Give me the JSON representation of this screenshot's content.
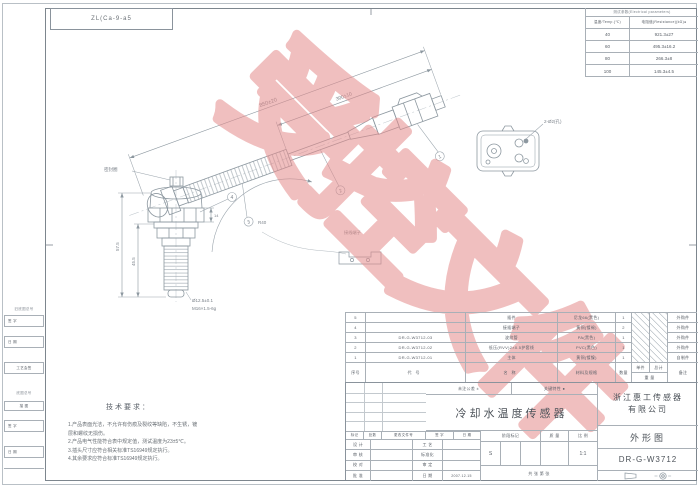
{
  "page": {
    "code_box": "ZL(Ca-9-a5",
    "watermark": "受控文件",
    "watermark_color": "#e58c8c"
  },
  "etable": {
    "title": "测试参数(Electrical parameters)",
    "col_temp": "温度/Temp.(℃)",
    "col_res": "电阻值(Resistance)(kΩ)●",
    "rows": [
      [
        "40",
        "921.3±27"
      ],
      [
        "60",
        "495.3±16.2"
      ],
      [
        "80",
        "266.3±8"
      ],
      [
        "100",
        "145.3±4.5"
      ]
    ]
  },
  "drawing": {
    "dim_overall": "850±20",
    "dim_cable": "300±10",
    "seal_label": "密封圈",
    "radius_label": "R40",
    "dim_h1": "57.5",
    "dim_h2": "45.5",
    "dim_hex": "14",
    "callout_dia": "Ø12.5±0.1",
    "callout_thread": "M16×1.5-6g",
    "connector_callout": "2-Ø2(孔)",
    "clip_label": "接线端子",
    "balloons": [
      "1",
      "2",
      "3",
      "4"
    ]
  },
  "notes": {
    "title": "技术要求：",
    "lines": [
      "1.产品表面光洁，不允许有伤痕及裂纹等缺陷，不生锈，镀",
      "   层和螺纹无损伤。",
      "2.产品电气性能符合表中规定值，测试温度为23±5℃。",
      "3.插头尺寸应符合相关标准TS16949规定执行。",
      "4.其余要求应符合标准TS16949规定执行。"
    ]
  },
  "bom": {
    "headers": {
      "no": "序号",
      "code": "代号",
      "name": "名称",
      "material": "材料及规格",
      "qty": "数量",
      "w1": "单件",
      "w2": "总计",
      "w": "重 量",
      "remark": "备注"
    },
    "rows": [
      [
        "5",
        "",
        "插件",
        "尼龙66(黑色)",
        "1",
        "外购件"
      ],
      [
        "4",
        "",
        "接插端子",
        "黄铜(镀锡)",
        "2",
        "外购件"
      ],
      [
        "3",
        "DR-G-W3712-03",
        "波纹管",
        "PA(黑色)",
        "1",
        "外购件"
      ],
      [
        "2",
        "DR-G-W3712-02",
        "低压(RVV)2×0.5护套线",
        "PVC(黑色)",
        "1",
        "外购件"
      ],
      [
        "1",
        "DR-G-W3712-01",
        "主体",
        "黄铜(镀镍)",
        "1",
        "自制件"
      ]
    ]
  },
  "tblock": {
    "rev_header": [
      "标记",
      "处数",
      "更改文件号",
      "签 字",
      "日 期"
    ],
    "sign_rows": [
      [
        "设 计",
        "工 艺"
      ],
      [
        "审 核",
        "标准化"
      ],
      [
        "校 对",
        "审 定"
      ],
      [
        "批 准",
        "日 期"
      ]
    ],
    "date": "2007.12.15",
    "tol": "未注公差 ±",
    "key": "关键特性 ●",
    "product": "冷却水温度传感器",
    "stage": "阶段标记",
    "mass": "质 量",
    "scale": "比 例",
    "stage_val": "S",
    "scale_val": "1:1",
    "sheet_info": "共  张   第  张",
    "company1": "浙江惠工传感器",
    "company2": "有限公司",
    "doc_type": "外形图",
    "dwg_no": "DR-G-W3712"
  },
  "margin": {
    "items": [
      "旧底图总号",
      "签 字",
      "日 期",
      "工艺会签",
      "底图总号",
      "描 图",
      "签 字",
      "日 期"
    ]
  }
}
